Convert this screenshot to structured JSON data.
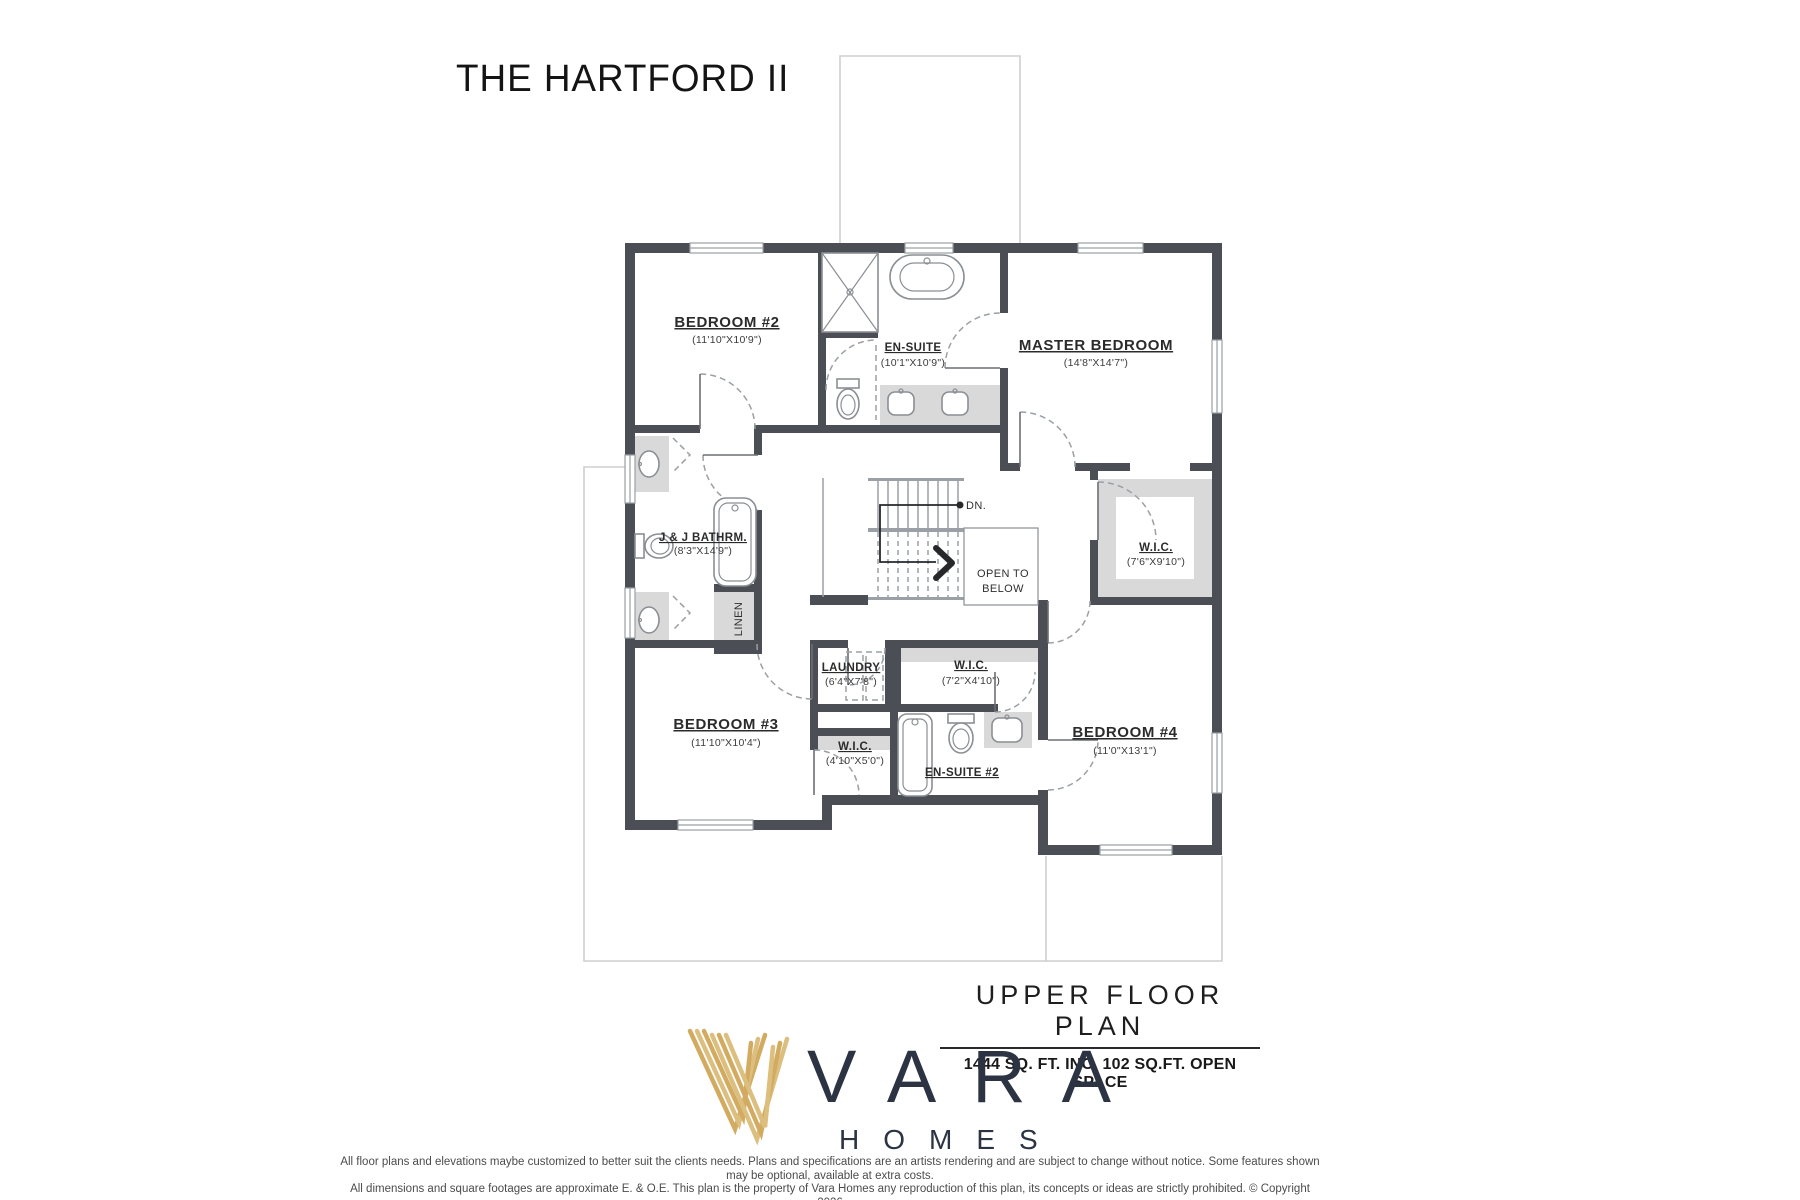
{
  "title": "THE HARTFORD II",
  "plan": {
    "labels": {
      "bedroom2_name": "BEDROOM #2",
      "bedroom2_dims": "(11'10\"X10'9\")",
      "ensuite_name": "EN-SUITE",
      "ensuite_dims": "(10'1\"X10'9\")",
      "master_name": "MASTER BEDROOM",
      "master_dims": "(14'8\"X14'7\")",
      "jj_name": "J & J BATHRM.",
      "jj_dims": "(8'3\"X14'9\")",
      "wic_master_name": "W.I.C.",
      "wic_master_dims": "(7'6\"X9'10\")",
      "dn": "DN.",
      "open_line1": "OPEN TO",
      "open_line2": "BELOW",
      "linen": "LINEN",
      "laundry_name": "LAUNDRY",
      "laundry_dims": "(6'4\"X7'8\")",
      "wic4_name": "W.I.C.",
      "wic4_dims": "(7'2\"X4'10\")",
      "bedroom3_name": "BEDROOM #3",
      "bedroom3_dims": "(11'10\"X10'4\")",
      "wic3_name": "W.I.C.",
      "wic3_dims": "(4'10\"X5'0\")",
      "ensuite2_name": "EN-SUITE #2",
      "bedroom4_name": "BEDROOM #4",
      "bedroom4_dims": "(11'0\"X13'1\")"
    }
  },
  "footer": {
    "plan_title": "UPPER FLOOR PLAN",
    "plan_subtitle": "1444 SQ. FT. INC. 102 SQ.FT. OPEN SPACE"
  },
  "brand": {
    "name": "VARA",
    "tagline": "HOMES"
  },
  "disclaimer": {
    "line1": "All floor plans and elevations maybe customized to better suit the clients needs. Plans and specifications are an artists rendering and are subject to change without notice. Some features shown may be optional, available at extra costs.",
    "line2": "All dimensions and square footages are approximate E. & O.E. This plan is the property of Vara Homes any reproduction of this plan, its concepts or ideas are strictly prohibited. © Copyright 2026"
  },
  "colors": {
    "wall": "#4b4f55",
    "gold": "#d2ab60",
    "gold_light": "#dcbe7e",
    "navy": "#2c3443",
    "shade": "#d9d9d9"
  }
}
